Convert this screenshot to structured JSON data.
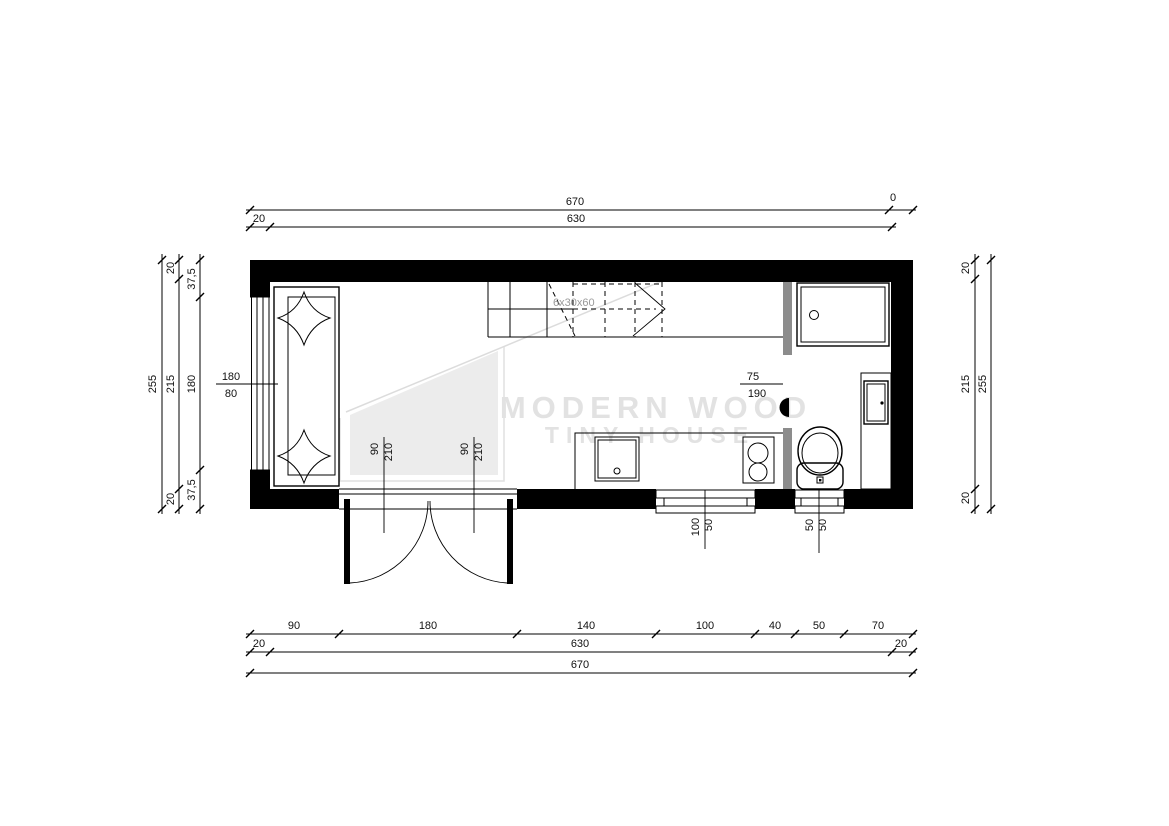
{
  "drawing": {
    "watermark": {
      "line1": "MODERN WOOD",
      "line2": "TINY HOUSE"
    },
    "labels": {
      "stairs": "6x30x60",
      "bath_door_width": "75",
      "bath_door_height": "190",
      "door_leaf_width": "90",
      "door_leaf_height": "210",
      "kitchen_opening_width": "100",
      "kitchen_opening_height": "50",
      "wc_opening_width": "50",
      "wc_opening_height": "50",
      "window_label_width": "180",
      "window_label_sill": "80"
    },
    "dim_top": {
      "total": "670",
      "zero_marker": "0",
      "wall": "20",
      "inner": "630"
    },
    "dim_bottom": {
      "segments": [
        "90",
        "180",
        "140",
        "100",
        "40",
        "50",
        "70"
      ],
      "wall_left": "20",
      "inner": "630",
      "wall_right": "20",
      "total": "670"
    },
    "dim_left": {
      "total": "255",
      "wall_top": "20",
      "inner": "215",
      "wall_bottom": "20",
      "window_top_offset": "37,5",
      "window_width": "180",
      "window_bottom_offset": "37,5"
    },
    "dim_right": {
      "wall_top": "20",
      "inner": "215",
      "wall_bottom": "20",
      "total": "255"
    },
    "colors": {
      "wall": "#000000",
      "partition": "#8c8c8c",
      "watermark_text": "#e2e2e2",
      "watermark_shape": "#ececec",
      "stairs_label": "#9a9a9a"
    }
  }
}
